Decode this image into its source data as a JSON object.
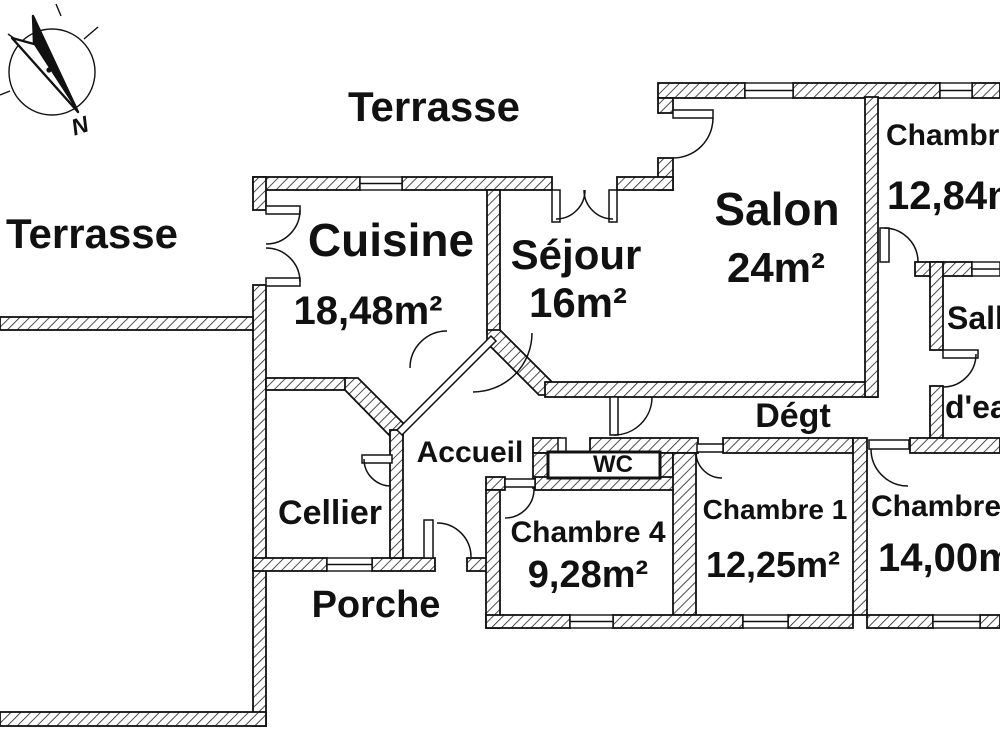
{
  "compass": {
    "north_label": "N"
  },
  "outdoor": {
    "terrasse_top": "Terrasse",
    "terrasse_left": "Terrasse",
    "porche": "Porche"
  },
  "rooms": {
    "cuisine": {
      "name": "Cuisine",
      "area": "18,48m²"
    },
    "sejour": {
      "name": "Séjour",
      "area": "16m²"
    },
    "salon": {
      "name": "Salon",
      "area": "24m²"
    },
    "chambre_nord": {
      "name": "Chambre",
      "area": "12,84m²"
    },
    "salle_eau": {
      "line1": "Salle",
      "line2": "d'eau"
    },
    "degagement": {
      "name": "Dégt"
    },
    "accueil": {
      "name": "Accueil"
    },
    "wc": {
      "name": "WC"
    },
    "cellier": {
      "name": "Cellier"
    },
    "chambre4": {
      "name": "Chambre 4",
      "area": "9,28m²"
    },
    "chambre1": {
      "name": "Chambre 1",
      "area": "12,25m²"
    },
    "chambre_sud": {
      "name": "Chambre",
      "area": "14,00m²"
    }
  },
  "colors": {
    "line": "#111111",
    "background": "#ffffff"
  }
}
